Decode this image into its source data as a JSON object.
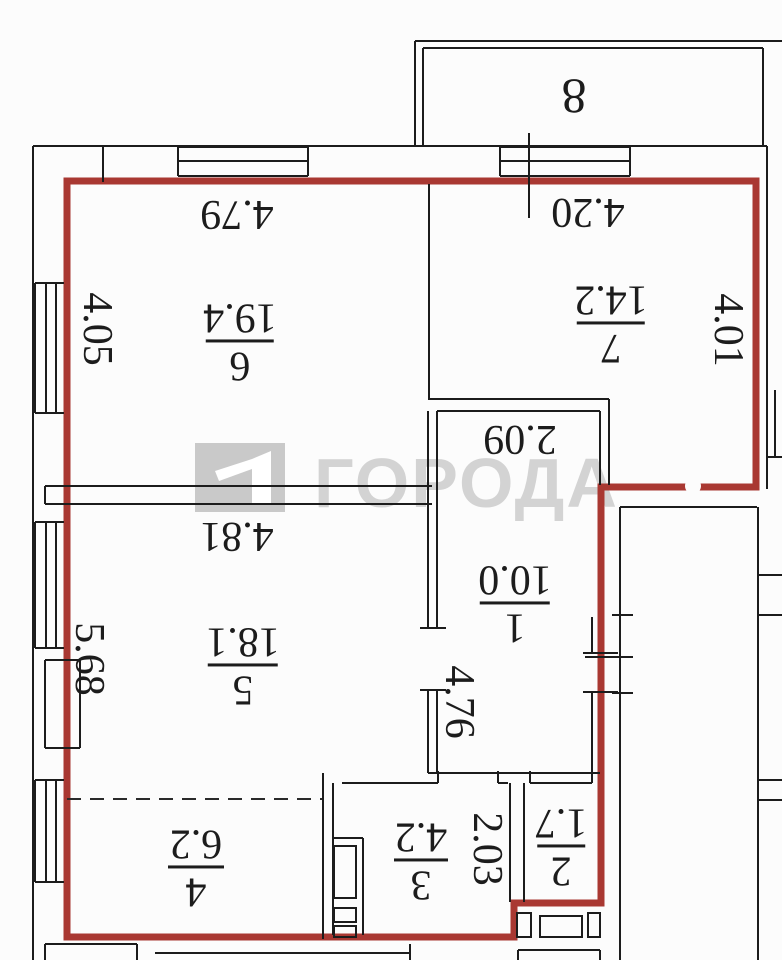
{
  "title": "apartment-floor-plan",
  "watermark": {
    "text": "ГОРОДА"
  },
  "rooms": [
    {
      "number": "6",
      "area": "19.4"
    },
    {
      "number": "7",
      "area": "14.2"
    },
    {
      "number": "5",
      "area": "18.1"
    },
    {
      "number": "4",
      "area": "6.2"
    },
    {
      "number": "3",
      "area": "4.2"
    },
    {
      "number": "2",
      "area": "1.7"
    },
    {
      "number": "1",
      "area": "10.0"
    },
    {
      "number": "8"
    }
  ],
  "dimensions": [
    {
      "value": "4.79"
    },
    {
      "value": "4.20"
    },
    {
      "value": "4.05"
    },
    {
      "value": "4.01"
    },
    {
      "value": "4.81"
    },
    {
      "value": "5.68"
    },
    {
      "value": "2.09"
    },
    {
      "value": "4.76"
    },
    {
      "value": "2.03"
    }
  ],
  "colors": {
    "boundary": "#a93832",
    "walls": "#1c1c1c",
    "watermark_gray": "#d3d3d3",
    "logo_gray": "#c9c9c9"
  }
}
